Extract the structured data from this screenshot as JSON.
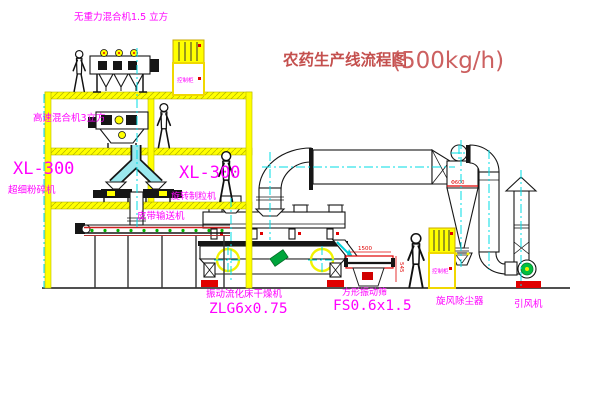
{
  "title": {
    "text": "农药生产线流程图",
    "capacity": "(500kg/h)"
  },
  "labels": {
    "gravity_free_mixer": "无重力混合机1.5 立方",
    "high_speed_mixer": "高速混合机3立方",
    "pulverizer_model": "XL-300",
    "pulverizer": "超细粉碎机",
    "granulator_model": "XL-300",
    "granulator": "旋转制粒机",
    "belt_conveyor": "皮带输送机",
    "dryer": "振动流化床干燥机",
    "dryer_model": "ZLG6x0.75",
    "sieve": "方形振动筛",
    "sieve_model": "FS0.6x1.5",
    "cyclone": "旋风除尘器",
    "fan": "引风机",
    "cabinet_top": "控制柜",
    "cabinet_right": "控制柜"
  },
  "dimensions": {
    "sieve_length": "1500",
    "sieve_height": "545",
    "cyclone_diameter": "Φ600"
  },
  "colors": {
    "label_magenta": "#ff00ff",
    "title_red": "#c4504e",
    "structure_yellow": "#ffff00",
    "centerline_cyan": "#00dde6",
    "accent_red": "#e00000",
    "roller_green": "#00b400"
  }
}
